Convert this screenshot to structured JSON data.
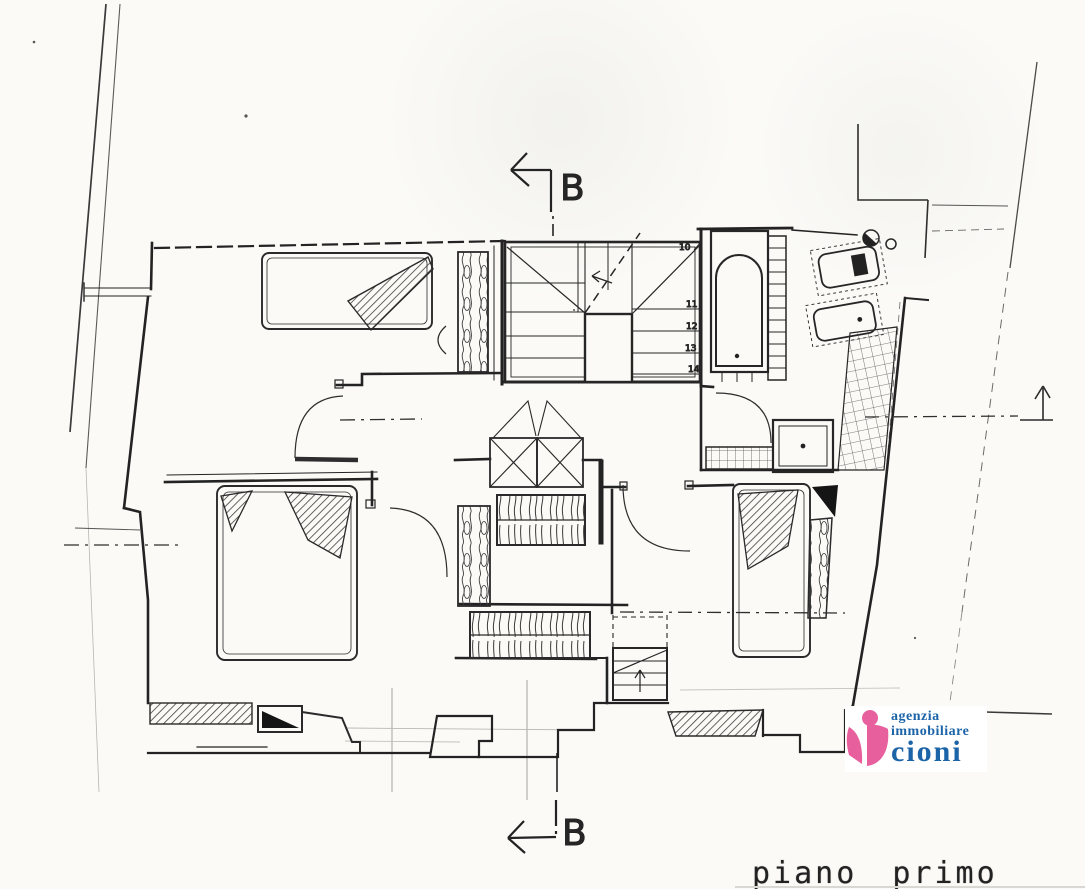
{
  "drawing": {
    "section_marker_top": "B",
    "section_marker_bottom": "B",
    "stair_step_numbers": [
      "10",
      "11",
      "12",
      "13",
      "14"
    ],
    "caption": "piano primo"
  },
  "logo": {
    "line1": "agenzia",
    "line2": "immobiliare",
    "line3": "cioni",
    "pink": "#e85f9e",
    "blue": "#1c64a8"
  },
  "colors": {
    "ink": "#2b2b2b",
    "paper": "#fbfaf7"
  }
}
